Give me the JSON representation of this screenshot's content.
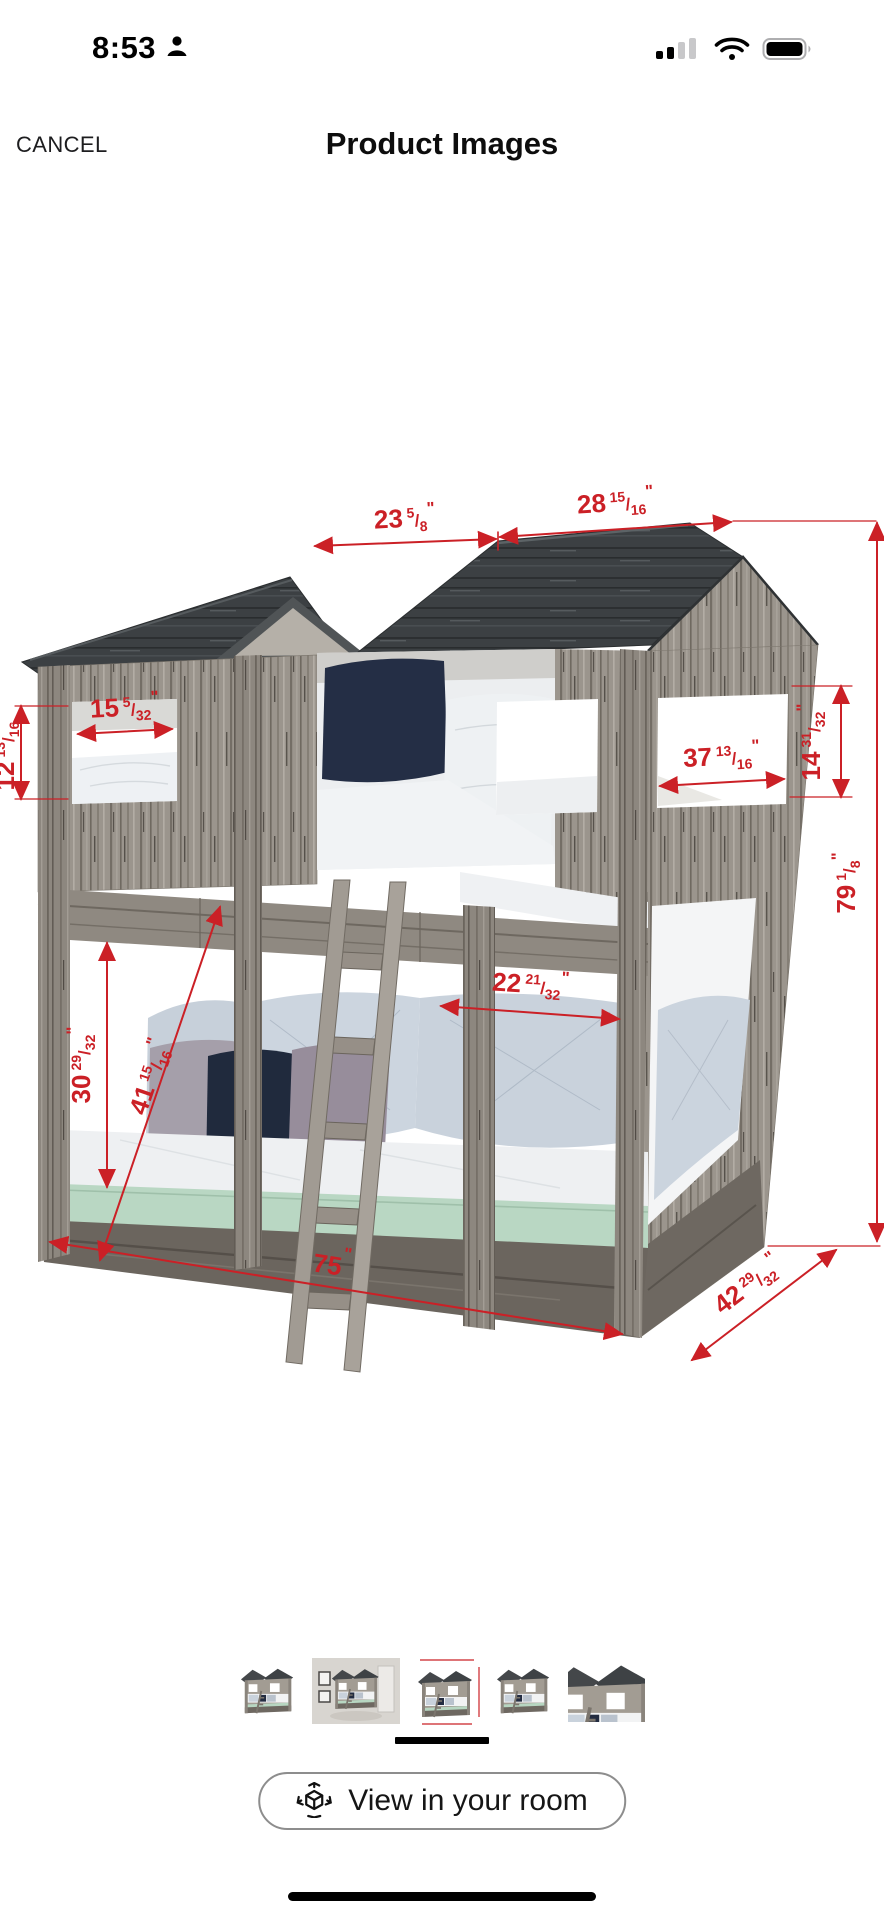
{
  "status_bar": {
    "time": "8:53",
    "icons": {
      "person": "person-icon",
      "signal": "cellular-signal-icon",
      "wifi": "wifi-icon",
      "battery": "battery-icon"
    }
  },
  "nav": {
    "cancel_label": "CANCEL",
    "title": "Product Images"
  },
  "product_image": {
    "description": "Rustic gray wood tower bunk bed with red dimension annotations",
    "accent_color": "#cb2026",
    "dims": {
      "roof_left": {
        "w": "23",
        "n": "5",
        "s": "/",
        "d": "8",
        "u": "\""
      },
      "roof_right": {
        "w": "28",
        "n": "15",
        "s": "/",
        "d": "16",
        "u": "\""
      },
      "window_left_w": {
        "w": "15",
        "n": "5",
        "s": "/",
        "d": "32",
        "u": "\""
      },
      "window_left_h": {
        "w": "12",
        "n": "13",
        "s": "/",
        "d": "16",
        "u": "\""
      },
      "window_right_w": {
        "w": "37",
        "n": "13",
        "s": "/",
        "d": "16",
        "u": "\""
      },
      "window_right_h": {
        "w": "14",
        "n": "31",
        "s": "/",
        "d": "32",
        "u": "\""
      },
      "total_height": {
        "w": "79",
        "n": "1",
        "s": "/",
        "d": "8",
        "u": "\""
      },
      "bunk_opening": {
        "w": "22",
        "n": "21",
        "s": "/",
        "d": "32",
        "u": "\""
      },
      "clearance": {
        "w": "30",
        "n": "29",
        "s": "/",
        "d": "32",
        "u": "\""
      },
      "ladder_length": {
        "w": "41",
        "n": "15",
        "s": "/",
        "d": "16",
        "u": "\""
      },
      "bed_length": {
        "w": "75",
        "n": "",
        "s": "",
        "d": "",
        "u": "\""
      },
      "bed_depth": {
        "w": "42",
        "n": "29",
        "s": "/",
        "d": "32",
        "u": "\""
      }
    }
  },
  "thumbnails": {
    "selected_index": 2,
    "items": [
      {
        "name": "bed-angle-view"
      },
      {
        "name": "bed-room-scene"
      },
      {
        "name": "bed-dimensions-view"
      },
      {
        "name": "bed-angle-view-2"
      },
      {
        "name": "bed-closeup-view"
      }
    ]
  },
  "footer": {
    "view_in_room_label": "View in your room",
    "icon": "ar-cube-icon"
  }
}
